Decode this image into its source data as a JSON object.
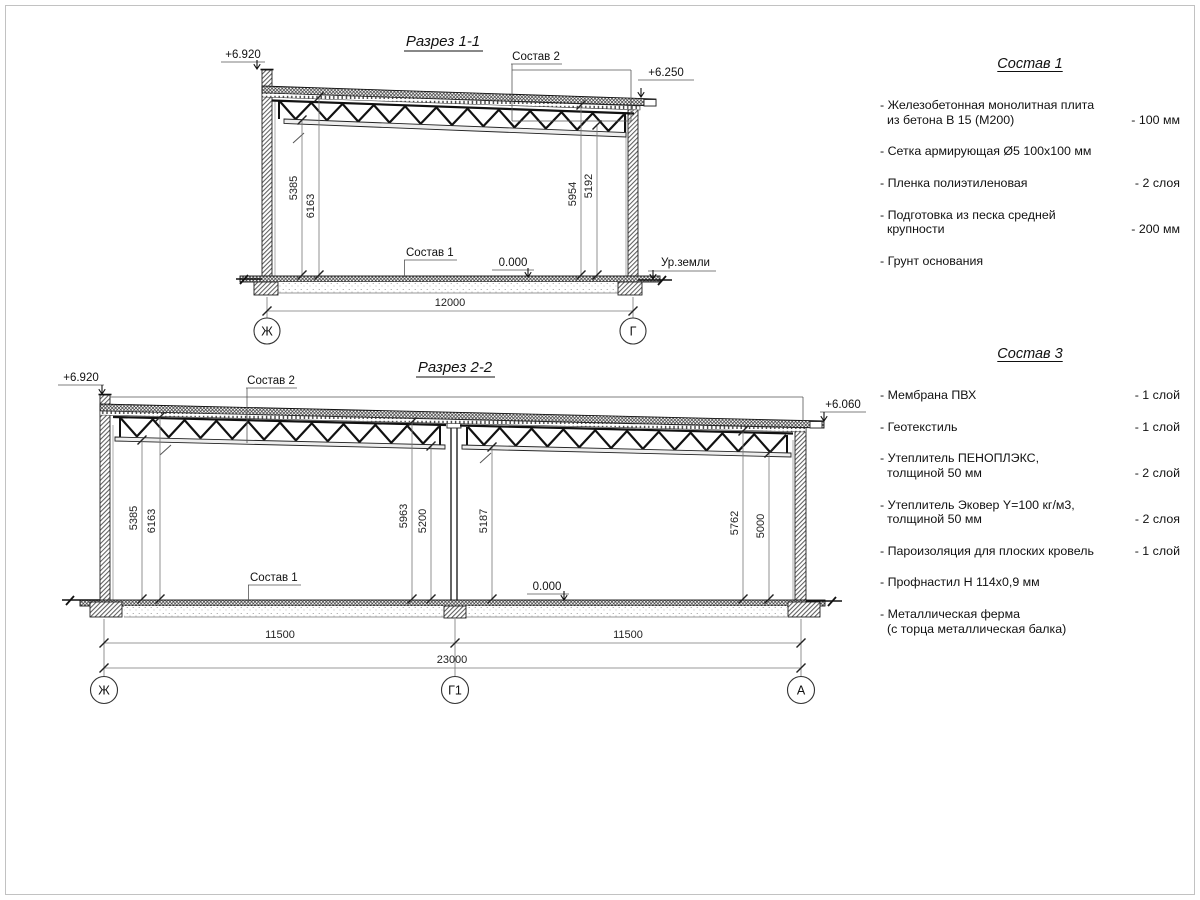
{
  "drawing": {
    "section1": {
      "title": "Разрез 1-1",
      "elev_left": "+6.920",
      "elev_right": "+6.250",
      "callout_roof": "Состав 2",
      "callout_floor": "Состав 1",
      "level_zero": "0.000",
      "ground_label": "Ур.земли",
      "dim_left_inner": "5385",
      "dim_left_outer": "6163",
      "dim_right_inner": "5954",
      "dim_right_outer": "5192",
      "dim_span": "12000",
      "axis_left": "Ж",
      "axis_right": "Г"
    },
    "section2": {
      "title": "Разрез 2-2",
      "elev_left": "+6.920",
      "elev_right": "+6.060",
      "callout_roof": "Состав 2",
      "callout_floor": "Состав 1",
      "level_zero": "0.000",
      "dims": {
        "d1": "5385",
        "d2": "6163",
        "d3": "5963",
        "d4": "5200",
        "d5": "5187",
        "d6": "5762",
        "d7": "5000"
      },
      "dim_span_left": "11500",
      "dim_span_right": "11500",
      "dim_total": "23000",
      "axis_left": "Ж",
      "axis_mid": "Г1",
      "axis_right": "А"
    }
  },
  "sostav1": {
    "title": "Состав 1",
    "items": [
      {
        "lines": [
          "- Железобетонная монолитная плита",
          "из бетона В 15 (М200)"
        ],
        "value": "- 100 мм"
      },
      {
        "lines": [
          "- Сетка армирующая Ø5 100х100 мм"
        ],
        "value": ""
      },
      {
        "lines": [
          "- Пленка полиэтиленовая"
        ],
        "value": "- 2 слоя"
      },
      {
        "lines": [
          "- Подготовка из песка средней",
          "крупности"
        ],
        "value": "- 200 мм"
      },
      {
        "lines": [
          "- Грунт основания"
        ],
        "value": ""
      }
    ]
  },
  "sostav3": {
    "title": "Состав 3",
    "items": [
      {
        "lines": [
          "- Мембрана ПВХ"
        ],
        "value": "- 1 слой"
      },
      {
        "lines": [
          "- Геотекстиль"
        ],
        "value": "- 1 слой"
      },
      {
        "lines": [
          "- Утеплитель ПЕНОПЛЭКС,",
          "толщиной 50 мм"
        ],
        "value": "- 2 слой"
      },
      {
        "lines": [
          "- Утеплитель Эковер Y=100 кг/м3,",
          "толщиной 50 мм"
        ],
        "value": "- 2 слоя"
      },
      {
        "lines": [
          "- Пароизоляция для плоских кровель"
        ],
        "value": "- 1 слой"
      },
      {
        "lines": [
          "- Профнастил Н 114х0,9 мм"
        ],
        "value": ""
      },
      {
        "lines": [
          "- Металлическая ферма",
          "(с торца металлическая балка)"
        ],
        "value": ""
      }
    ]
  }
}
